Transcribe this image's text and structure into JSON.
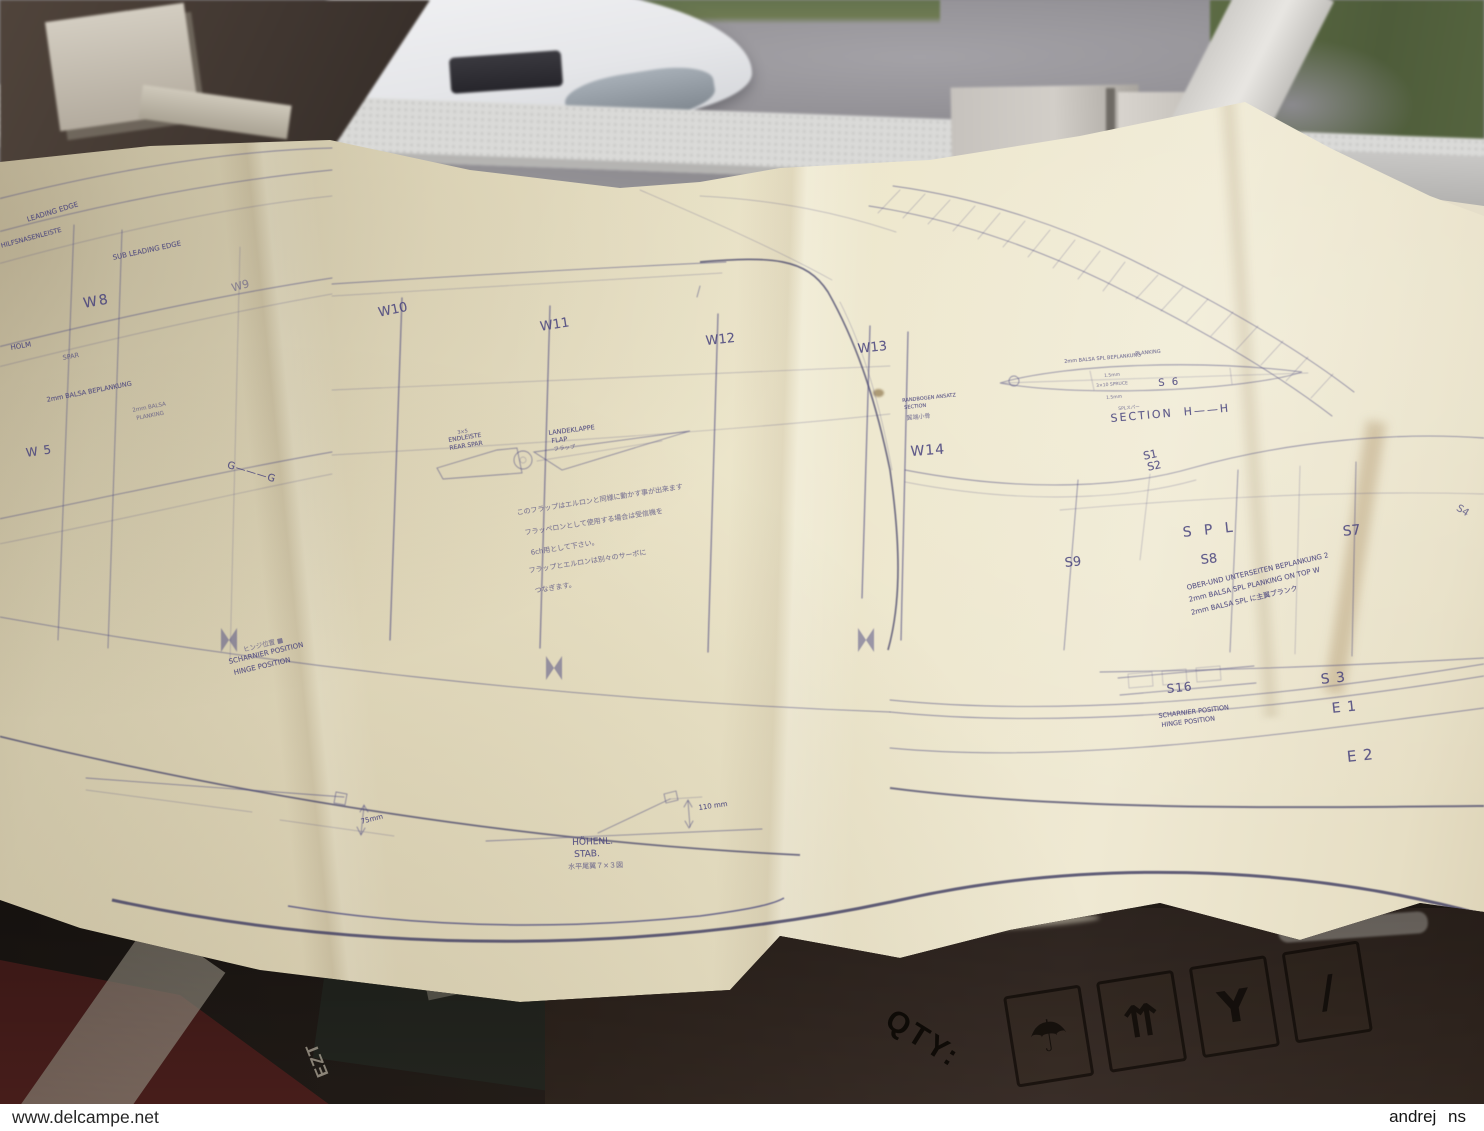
{
  "watermarks": {
    "left": "www.delcampe.net",
    "right": "andrej ns"
  },
  "colors": {
    "paper": "#e9e2c6",
    "ink": "#47457f",
    "box": "#342a22",
    "road": "#8e8c90",
    "grass": "#5c6b44",
    "sill": "#dadad8"
  },
  "box": {
    "qty_label": "QTY:",
    "newsprint_letters": "EZT",
    "icons": [
      {
        "name": "keep-dry-umbrella-icon",
        "glyph": "☂"
      },
      {
        "name": "this-way-up-icon",
        "glyph": "⇈"
      },
      {
        "name": "fragile-icon",
        "glyph": "Y"
      },
      {
        "name": "stacking-limit-icon",
        "glyph": "/"
      }
    ]
  },
  "plan": {
    "labels": [
      {
        "text": "LEADING EDGE",
        "x": 26,
        "y": 216,
        "size": 7,
        "rot": -17
      },
      {
        "text": "HILFSNASENLEISTE",
        "x": 0,
        "y": 242,
        "size": 6.5,
        "rot": -15
      },
      {
        "text": "SUB LEADING EDGE",
        "x": 112,
        "y": 254,
        "size": 7,
        "rot": -12
      },
      {
        "text": "W8",
        "x": 82,
        "y": 296,
        "size": 14,
        "rot": -10,
        "ls": 2
      },
      {
        "text": "W9",
        "x": 230,
        "y": 282,
        "size": 11,
        "rot": -16,
        "o": 0.5
      },
      {
        "text": "W10",
        "x": 377,
        "y": 306,
        "size": 13,
        "rot": -12
      },
      {
        "text": "W11",
        "x": 539,
        "y": 320,
        "size": 13,
        "rot": -9
      },
      {
        "text": "W12",
        "x": 705,
        "y": 334,
        "size": 13,
        "rot": -6
      },
      {
        "text": "W13",
        "x": 857,
        "y": 342,
        "size": 13,
        "rot": -6
      },
      {
        "text": "W14",
        "x": 910,
        "y": 444,
        "size": 14,
        "rot": -4,
        "ls": 1
      },
      {
        "text": "HOLM",
        "x": 10,
        "y": 344,
        "size": 7,
        "rot": -10
      },
      {
        "text": "SPAR",
        "x": 62,
        "y": 354,
        "size": 6.5,
        "rot": -10,
        "o": 0.65
      },
      {
        "text": "2mm BALSA BEPLANKUNG",
        "x": 46,
        "y": 396,
        "size": 6.5,
        "rot": -11
      },
      {
        "text": "2mm BALSA",
        "x": 132,
        "y": 408,
        "size": 5.5,
        "rot": -11,
        "o": 0.6
      },
      {
        "text": "PLANKING",
        "x": 136,
        "y": 416,
        "size": 5.5,
        "rot": -11,
        "o": 0.6
      },
      {
        "text": "W 5",
        "x": 25,
        "y": 446,
        "size": 12,
        "rot": -8,
        "ls": 1
      },
      {
        "text": "G———G",
        "x": 229,
        "y": 460,
        "size": 10,
        "rot": 17,
        "ls": 1
      },
      {
        "text": "3×5",
        "x": 457,
        "y": 430,
        "size": 5,
        "rot": -9,
        "o": 0.7
      },
      {
        "text": "ENDLEISTE",
        "x": 448,
        "y": 437,
        "size": 6,
        "rot": -9
      },
      {
        "text": "REAR SPAR",
        "x": 449,
        "y": 445,
        "size": 6,
        "rot": -9
      },
      {
        "text": "LANDEKLAPPE",
        "x": 548,
        "y": 429,
        "size": 6.5,
        "rot": -7
      },
      {
        "text": "FLAP",
        "x": 551,
        "y": 437,
        "size": 6.5,
        "rot": -7
      },
      {
        "text": "フラップ",
        "x": 553,
        "y": 445,
        "size": 5.5,
        "rot": -7,
        "o": 0.6
      },
      {
        "text": "このフラップはエルロンと同様に動かす事が出来ます",
        "x": 516,
        "y": 508,
        "size": 7,
        "rot": -9,
        "o": 0.65
      },
      {
        "text": "フラッペロンとして使用する場合は受信機を",
        "x": 524,
        "y": 528,
        "size": 7,
        "rot": -9,
        "o": 0.65
      },
      {
        "text": "6ch用として下さい。",
        "x": 530,
        "y": 548,
        "size": 7,
        "rot": -9,
        "o": 0.65
      },
      {
        "text": "フラップとエルロンは別々のサーボに",
        "x": 528,
        "y": 566,
        "size": 7,
        "rot": -9,
        "o": 0.65
      },
      {
        "text": "つなぎます。",
        "x": 534,
        "y": 586,
        "size": 7,
        "rot": -9,
        "o": 0.65
      },
      {
        "text": "ヒンジ位置 ■",
        "x": 242,
        "y": 644,
        "size": 6.5,
        "rot": -14,
        "o": 0.6
      },
      {
        "text": "SCHARNIER POSITION",
        "x": 228,
        "y": 658,
        "size": 7,
        "rot": -13
      },
      {
        "text": "HINGE POSITION",
        "x": 233,
        "y": 669,
        "size": 7,
        "rot": -13
      },
      {
        "text": "RANDBOGEN ANSATZ",
        "x": 902,
        "y": 398,
        "size": 5,
        "rot": -6
      },
      {
        "text": "SECTION",
        "x": 904,
        "y": 405,
        "size": 5,
        "rot": -6
      },
      {
        "text": "翼端小骨",
        "x": 906,
        "y": 413,
        "size": 6,
        "rot": -6,
        "o": 0.6
      },
      {
        "text": "PLANKING",
        "x": 1135,
        "y": 351,
        "size": 5,
        "rot": -5,
        "o": 0.7
      },
      {
        "text": "2mm BALSA SPL BEPLANKUNG",
        "x": 1064,
        "y": 359,
        "size": 5,
        "rot": -5,
        "o": 0.7
      },
      {
        "text": "1.5mm",
        "x": 1104,
        "y": 374,
        "size": 4.5,
        "rot": -5,
        "o": 0.6
      },
      {
        "text": "3×10 SPRUCE",
        "x": 1096,
        "y": 384,
        "size": 4.5,
        "rot": -5,
        "o": 0.6
      },
      {
        "text": "S 6",
        "x": 1158,
        "y": 378,
        "size": 10,
        "rot": -4,
        "ls": 2
      },
      {
        "text": "1.5mm",
        "x": 1106,
        "y": 396,
        "size": 4.5,
        "rot": -5,
        "o": 0.6
      },
      {
        "text": "SPLスパー",
        "x": 1118,
        "y": 406,
        "size": 4.5,
        "rot": -5,
        "o": 0.6
      },
      {
        "text": "SECTION  H——H",
        "x": 1110,
        "y": 412,
        "size": 11,
        "rot": -5,
        "ls": 2
      },
      {
        "text": "S1",
        "x": 1142,
        "y": 450,
        "size": 11,
        "rot": -12
      },
      {
        "text": "S2",
        "x": 1146,
        "y": 461,
        "size": 11,
        "rot": -12
      },
      {
        "text": "S P L",
        "x": 1182,
        "y": 525,
        "size": 14,
        "rot": -6,
        "ls": 4
      },
      {
        "text": "S7",
        "x": 1342,
        "y": 524,
        "size": 14,
        "rot": -6
      },
      {
        "text": "S8",
        "x": 1200,
        "y": 553,
        "size": 13,
        "rot": -6
      },
      {
        "text": "S9",
        "x": 1064,
        "y": 556,
        "size": 13,
        "rot": -6
      },
      {
        "text": "S4",
        "x": 1460,
        "y": 503,
        "size": 10,
        "rot": 32,
        "o": 0.7
      },
      {
        "text": "OBER-UND UNTERSEITEN BEPLANKUNG 2",
        "x": 1186,
        "y": 584,
        "size": 7,
        "rot": -13
      },
      {
        "text": "2mm BALSA SPL PLANKING ON TOP W",
        "x": 1188,
        "y": 596,
        "size": 7,
        "rot": -13
      },
      {
        "text": "2mm BALSA SPL に主翼プランク",
        "x": 1190,
        "y": 608,
        "size": 7,
        "rot": -13
      },
      {
        "text": "S16",
        "x": 1166,
        "y": 682,
        "size": 12,
        "rot": -6,
        "ls": 1
      },
      {
        "text": "S 3",
        "x": 1320,
        "y": 672,
        "size": 14,
        "rot": -6,
        "ls": 1
      },
      {
        "text": "E 1",
        "x": 1331,
        "y": 701,
        "size": 14,
        "rot": -6,
        "ls": 1
      },
      {
        "text": "E 2",
        "x": 1346,
        "y": 748,
        "size": 15,
        "rot": -6,
        "ls": 1
      },
      {
        "text": "SCHARNIER POSITION",
        "x": 1158,
        "y": 712,
        "size": 6.5,
        "rot": -7
      },
      {
        "text": "HINGE POSITION",
        "x": 1161,
        "y": 721,
        "size": 6.5,
        "rot": -7
      },
      {
        "text": "HÖHENL.",
        "x": 572,
        "y": 838,
        "size": 9,
        "rot": -2
      },
      {
        "text": "STAB.",
        "x": 574,
        "y": 850,
        "size": 9,
        "rot": -2
      },
      {
        "text": "水平尾翼７×３図",
        "x": 568,
        "y": 862,
        "size": 7,
        "rot": -2,
        "o": 0.65
      },
      {
        "text": "75mm",
        "x": 360,
        "y": 818,
        "size": 7,
        "rot": -14
      },
      {
        "text": "110 mm",
        "x": 698,
        "y": 804,
        "size": 7,
        "rot": -8
      }
    ]
  }
}
